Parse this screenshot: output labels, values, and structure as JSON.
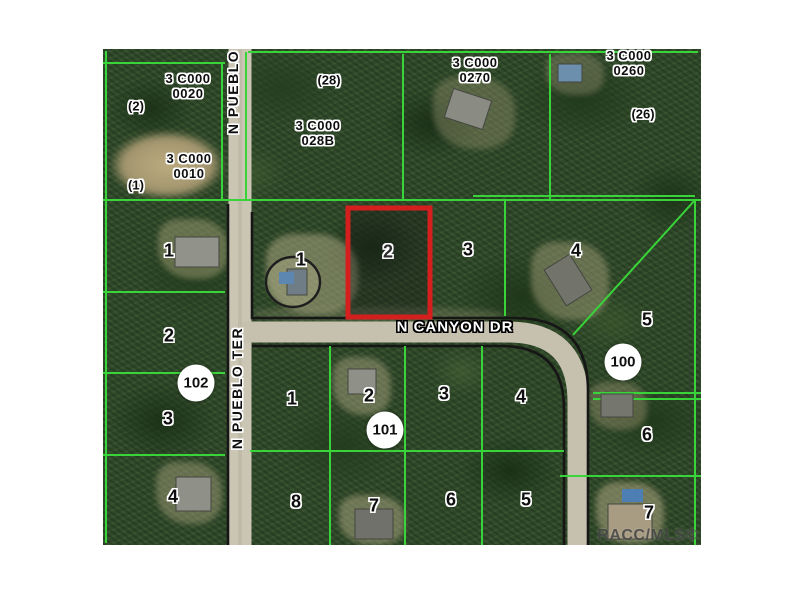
{
  "map": {
    "watermark": "RACC/MLS©",
    "colors": {
      "parcel_line_green": "#39d439",
      "boundary_black": "#161616",
      "highlight_red": "#d51f1f",
      "road_gray": "#c9c3b2",
      "circle_fill": "#ffffff"
    },
    "road_labels": [
      {
        "text": "N PUEBLO",
        "orientation": "vertical"
      },
      {
        "text": "N PUEBLO TER",
        "orientation": "vertical"
      },
      {
        "text": "N CANYON DR",
        "orientation": "horizontal"
      }
    ],
    "block_labels": [
      {
        "line1": "3 C000",
        "line2": "0020"
      },
      {
        "line1": "3 C000",
        "line2": "0010"
      },
      {
        "line1": "3 C000",
        "line2": "028B"
      },
      {
        "line1": "3 C000",
        "line2": "0270"
      },
      {
        "line1": "3 C000",
        "line2": "0260"
      }
    ],
    "alt_key_labels": [
      "(2)",
      "(1)",
      "(28)",
      "(26)"
    ],
    "street_number_circles": [
      "102",
      "101",
      "100"
    ],
    "highlighted_lot": "2",
    "lot_numbers": [
      "1",
      "1",
      "3",
      "4",
      "5",
      "2",
      "3",
      "4",
      "1",
      "2",
      "3",
      "4",
      "8",
      "7",
      "6",
      "5",
      "6",
      "7"
    ]
  }
}
